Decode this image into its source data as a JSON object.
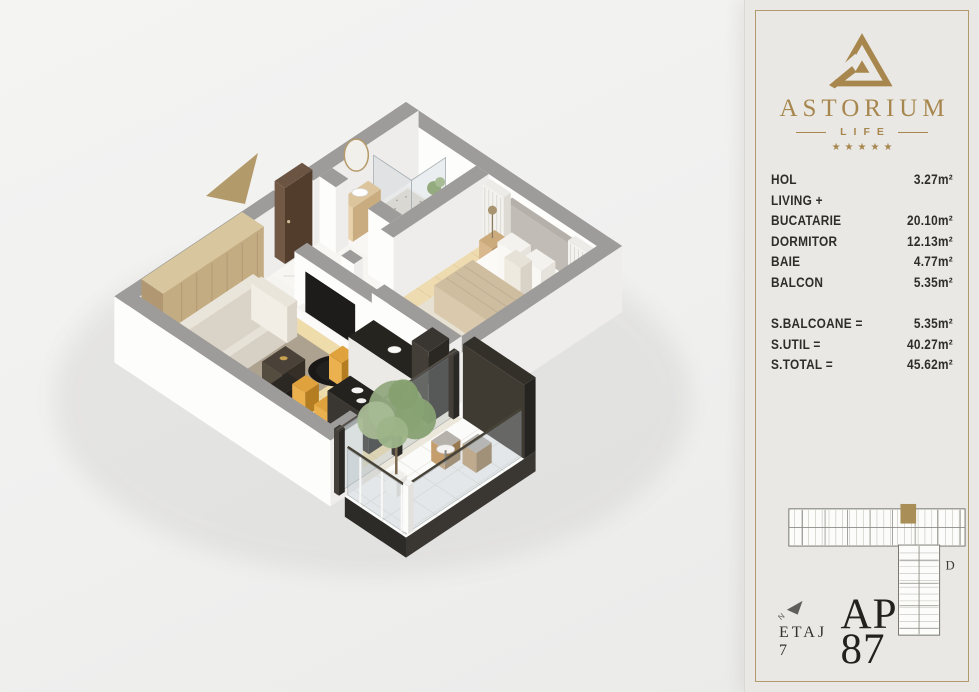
{
  "brand": {
    "name": "ASTORIUM",
    "tagline": "LIFE",
    "stars": "★★★★★"
  },
  "room_list": [
    {
      "label": "HOL",
      "value": "3.27m²"
    },
    {
      "label": "LIVING +",
      "value": ""
    },
    {
      "label": "BUCATARIE",
      "value": "20.10m²"
    },
    {
      "label": "DORMITOR",
      "value": "12.13m²"
    },
    {
      "label": "BAIE",
      "value": "4.77m²"
    },
    {
      "label": "BALCON",
      "value": "5.35m²"
    }
  ],
  "totals": [
    {
      "label": "S.BALCOANE =",
      "value": "5.35m²"
    },
    {
      "label": "S.UTIL =",
      "value": "40.27m²"
    },
    {
      "label": "S.TOTAL =",
      "value": "45.62m²"
    }
  ],
  "footer": {
    "floor_label": "ETAJ 7",
    "apartment_label": "AP 87"
  },
  "site_plan": {
    "section_label": "D",
    "north_label": "N"
  },
  "colors": {
    "gold": "#a8874f",
    "gold_soft": "#b39a6a",
    "dark_text": "#2e2d2a",
    "panel_bg": "#e9e8e4",
    "canvas_bg": "#f1f1f0",
    "highlight_unit": "#a98e58",
    "wall_gray": "#9d9c9a",
    "wood_floor": "#eedbae"
  }
}
